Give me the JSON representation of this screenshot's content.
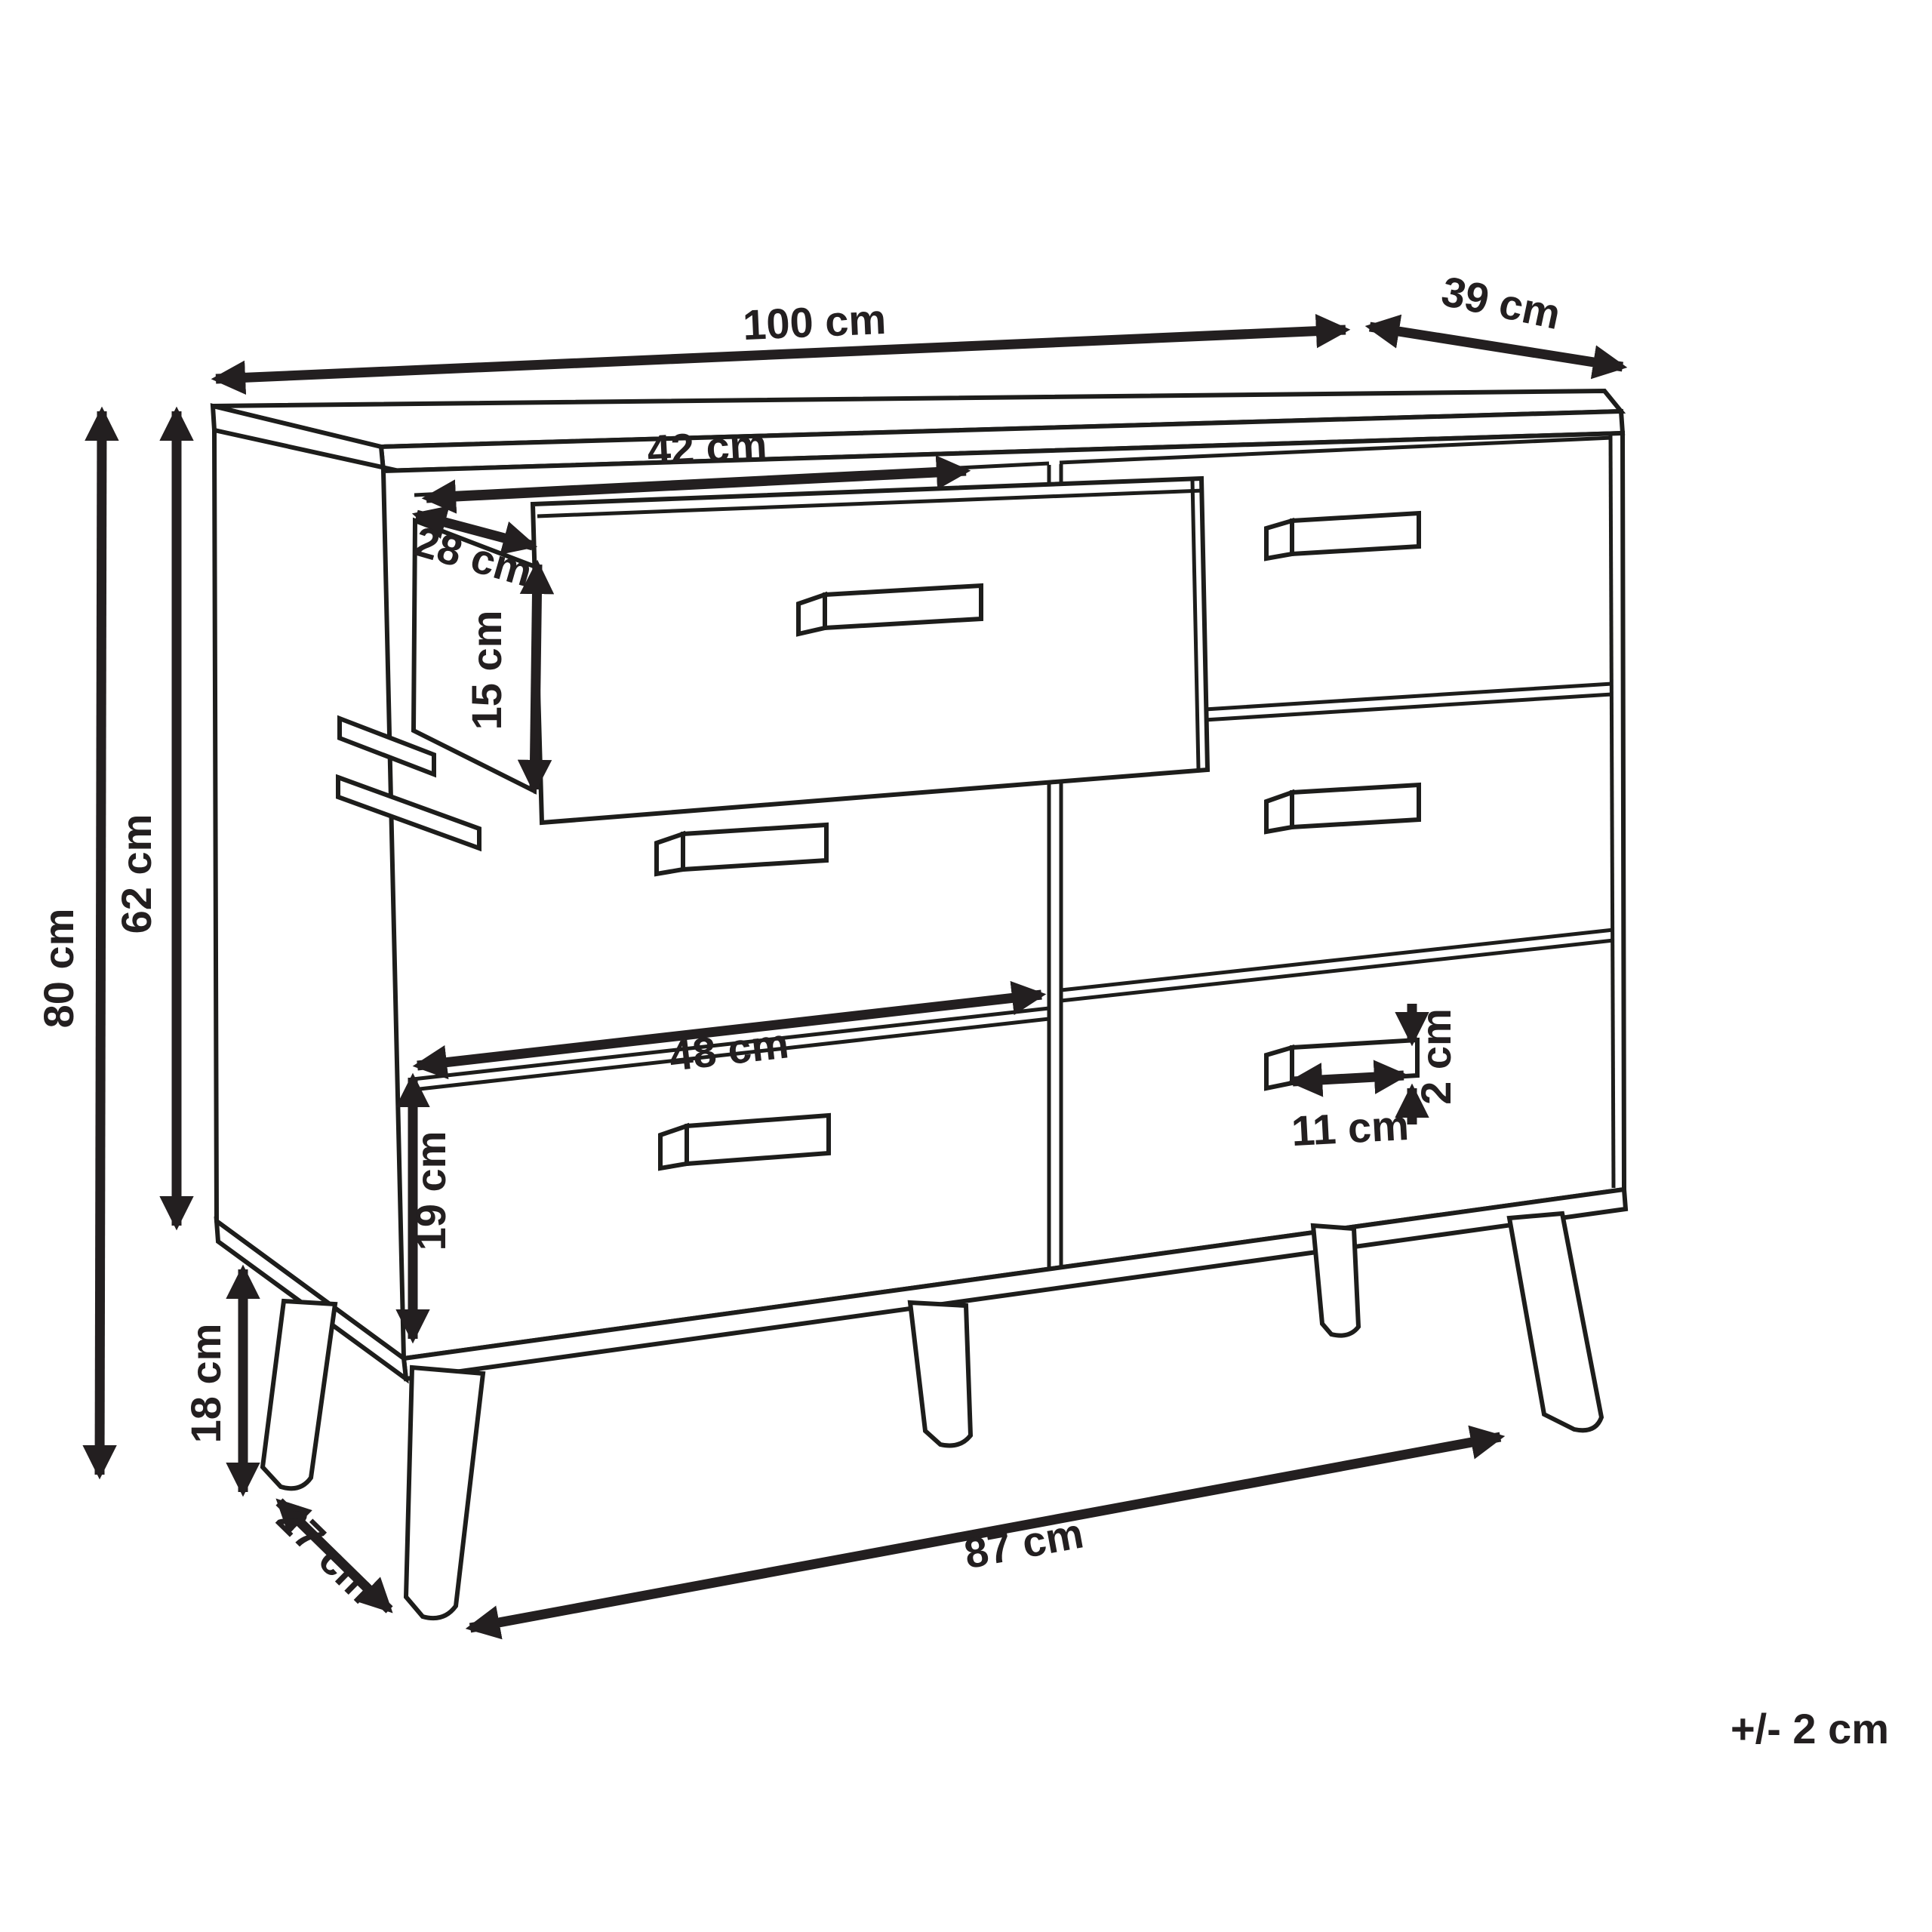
{
  "diagram": {
    "type": "furniture-dimension-line-drawing",
    "subject": "chest of drawers with six drawers, top-left drawer pulled open, splayed legs",
    "unit": "cm",
    "line_color": "#1d1d1b",
    "background_color": "#ffffff",
    "tolerance_note": "+/- 2 cm",
    "dimensions": {
      "overall_width": {
        "label": "100 cm",
        "value": 100
      },
      "depth": {
        "label": "39 cm",
        "value": 39
      },
      "open_drawer_width": {
        "label": "42 cm",
        "value": 42
      },
      "open_drawer_depth": {
        "label": "28 cm",
        "value": 28
      },
      "open_drawer_height": {
        "label": "15 cm",
        "value": 15
      },
      "carcass_height": {
        "label": "62 cm",
        "value": 62
      },
      "overall_height": {
        "label": "80 cm",
        "value": 80
      },
      "bottom_drawer_width": {
        "label": "48 cm",
        "value": 48
      },
      "bottom_drawer_height": {
        "label": "19 cm",
        "value": 19
      },
      "handle_width": {
        "label": "11 cm",
        "value": 11
      },
      "handle_height": {
        "label": "2 cm",
        "value": 2
      },
      "leg_height": {
        "label": "18 cm",
        "value": 18
      },
      "leg_inset_depth": {
        "label": "27 cm",
        "value": 27
      },
      "leg_span_width": {
        "label": "87 cm",
        "value": 87
      }
    }
  }
}
